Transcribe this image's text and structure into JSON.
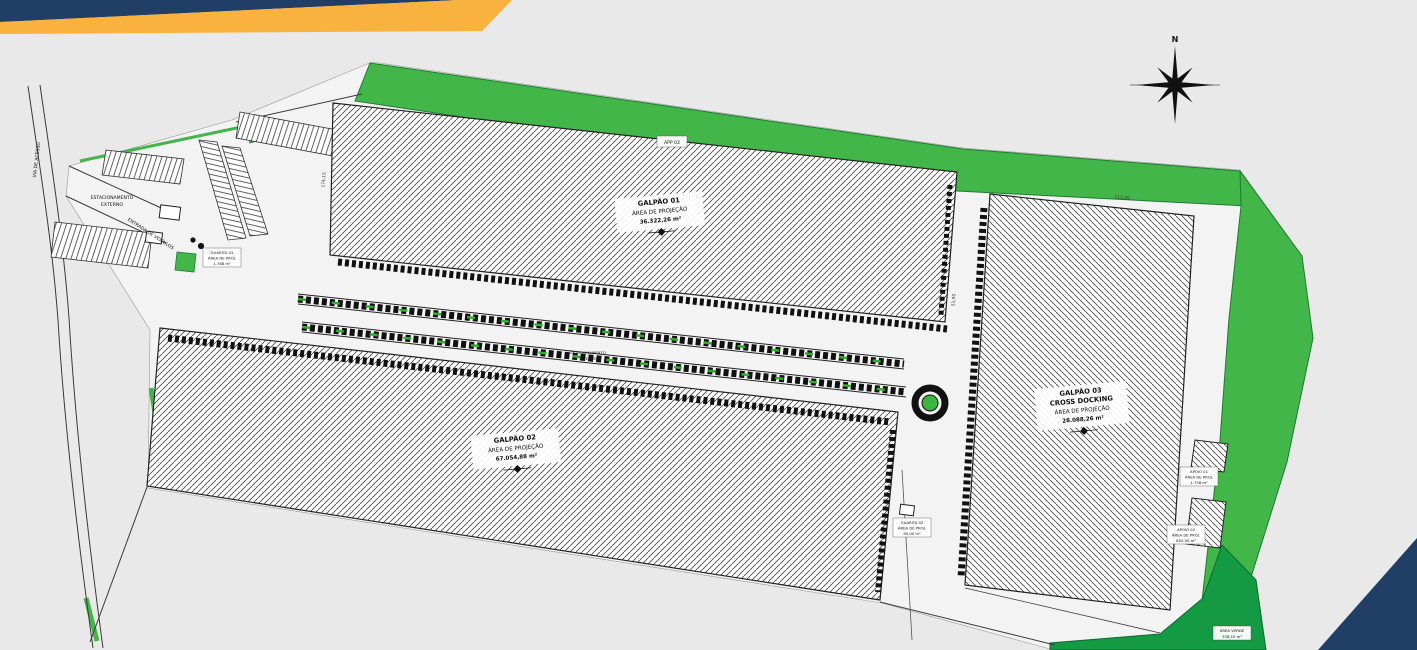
{
  "colors": {
    "background": "#e9e9e9",
    "site_fill": "#f3f3f3",
    "ribbon_navy": "#213e66",
    "ribbon_yellow": "#f8b23d",
    "green_light": "#43b649",
    "green_dark": "#139a43",
    "roundabout_green": "#3cb53c"
  },
  "compass": {
    "north": "N"
  },
  "warehouses": {
    "g1": {
      "title": "GALPÃO 01",
      "subtitle": "ÁREA DE PROJEÇÃO",
      "area": "36.322,26 m²"
    },
    "g2": {
      "title": "GALPÃO 02",
      "subtitle": "ÁREA DE PROJEÇÃO",
      "area": "67.054,88 m²"
    },
    "g3": {
      "title": "GALPÃO 03",
      "docking": "CROSS DOCKING",
      "subtitle": "ÁREA DE PROJEÇÃO",
      "area": "28.088,26 m²"
    }
  },
  "labels": {
    "app": "APP 02",
    "parking_ext1": "ESTACIONAMENTO",
    "parking_ext2": "EXTERNO",
    "parking_int1": "ESTACIONAMENTO",
    "parking_int2": "INTERNO",
    "entrance": "ENTRADA DE VEÍCULOS",
    "access_road": "VIA DE ACESSO",
    "guarita1": {
      "t": "GUARITA 01",
      "l": "ÁREA DE PROJ.",
      "a": "1.768 m²"
    },
    "guarita2": {
      "t": "GUARITA 02",
      "l": "ÁREA DE PROJ.",
      "a": "90,00 m²"
    },
    "apoio1": {
      "t": "APOIO 01",
      "l": "ÁREA DE PROJ.",
      "a": "1.758 m²"
    },
    "apoio2": {
      "t": "APOIO 02",
      "l": "ÁREA DE PROJ.",
      "a": "850,00 m²"
    },
    "green_area": {
      "t": "ÁREA VERDE",
      "a": "338,10 m²"
    }
  },
  "dimensions": {
    "d1": "112,95",
    "d2": "174,15",
    "d3": "51,95"
  }
}
